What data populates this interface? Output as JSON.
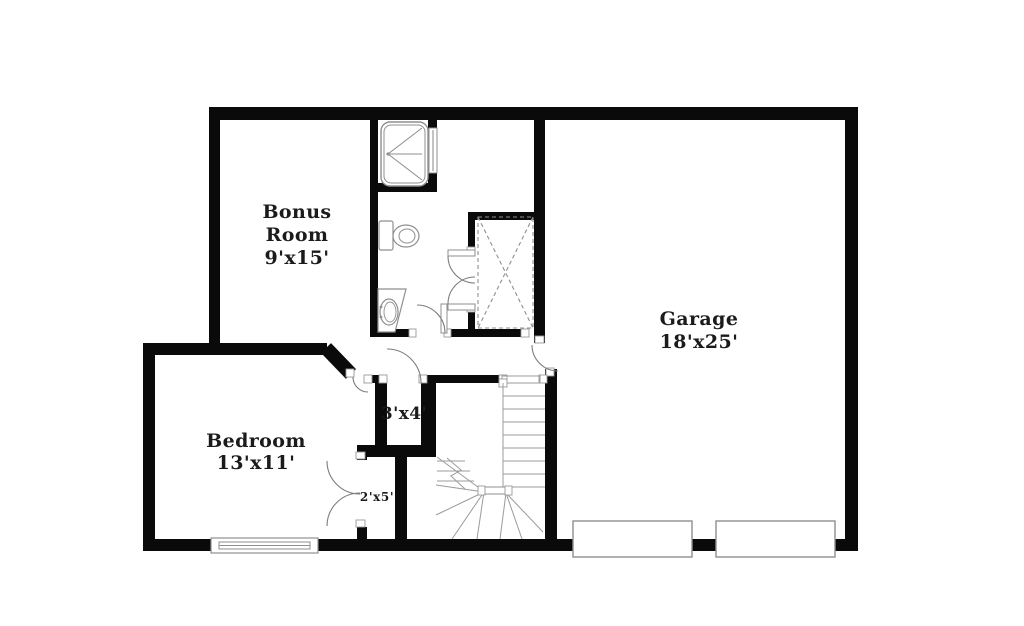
{
  "canvas": {
    "width": 1024,
    "height": 626
  },
  "palette": {
    "background": "#ffffff",
    "wall": "#0a0a0a",
    "fixture_line": "#8f8f8f",
    "door_line": "#7d7d7d",
    "text": "#1b1b1b"
  },
  "rooms": {
    "bonus_room": {
      "name_line1": "Bonus",
      "name_line2": "Room",
      "dims": "9'x15'"
    },
    "garage": {
      "name": "Garage",
      "dims": "18'x25'"
    },
    "bedroom": {
      "name": "Bedroom",
      "dims": "13'x11'"
    },
    "closet_3x4": {
      "dims": "3'x4'"
    },
    "closet_2x5": {
      "dims": "2'x5'"
    }
  },
  "fixtures": [
    "shower",
    "toilet",
    "sink-vanity",
    "storage-area-x",
    "staircase-with-winders",
    "bedroom-window",
    "garage-door-left",
    "garage-door-right"
  ]
}
